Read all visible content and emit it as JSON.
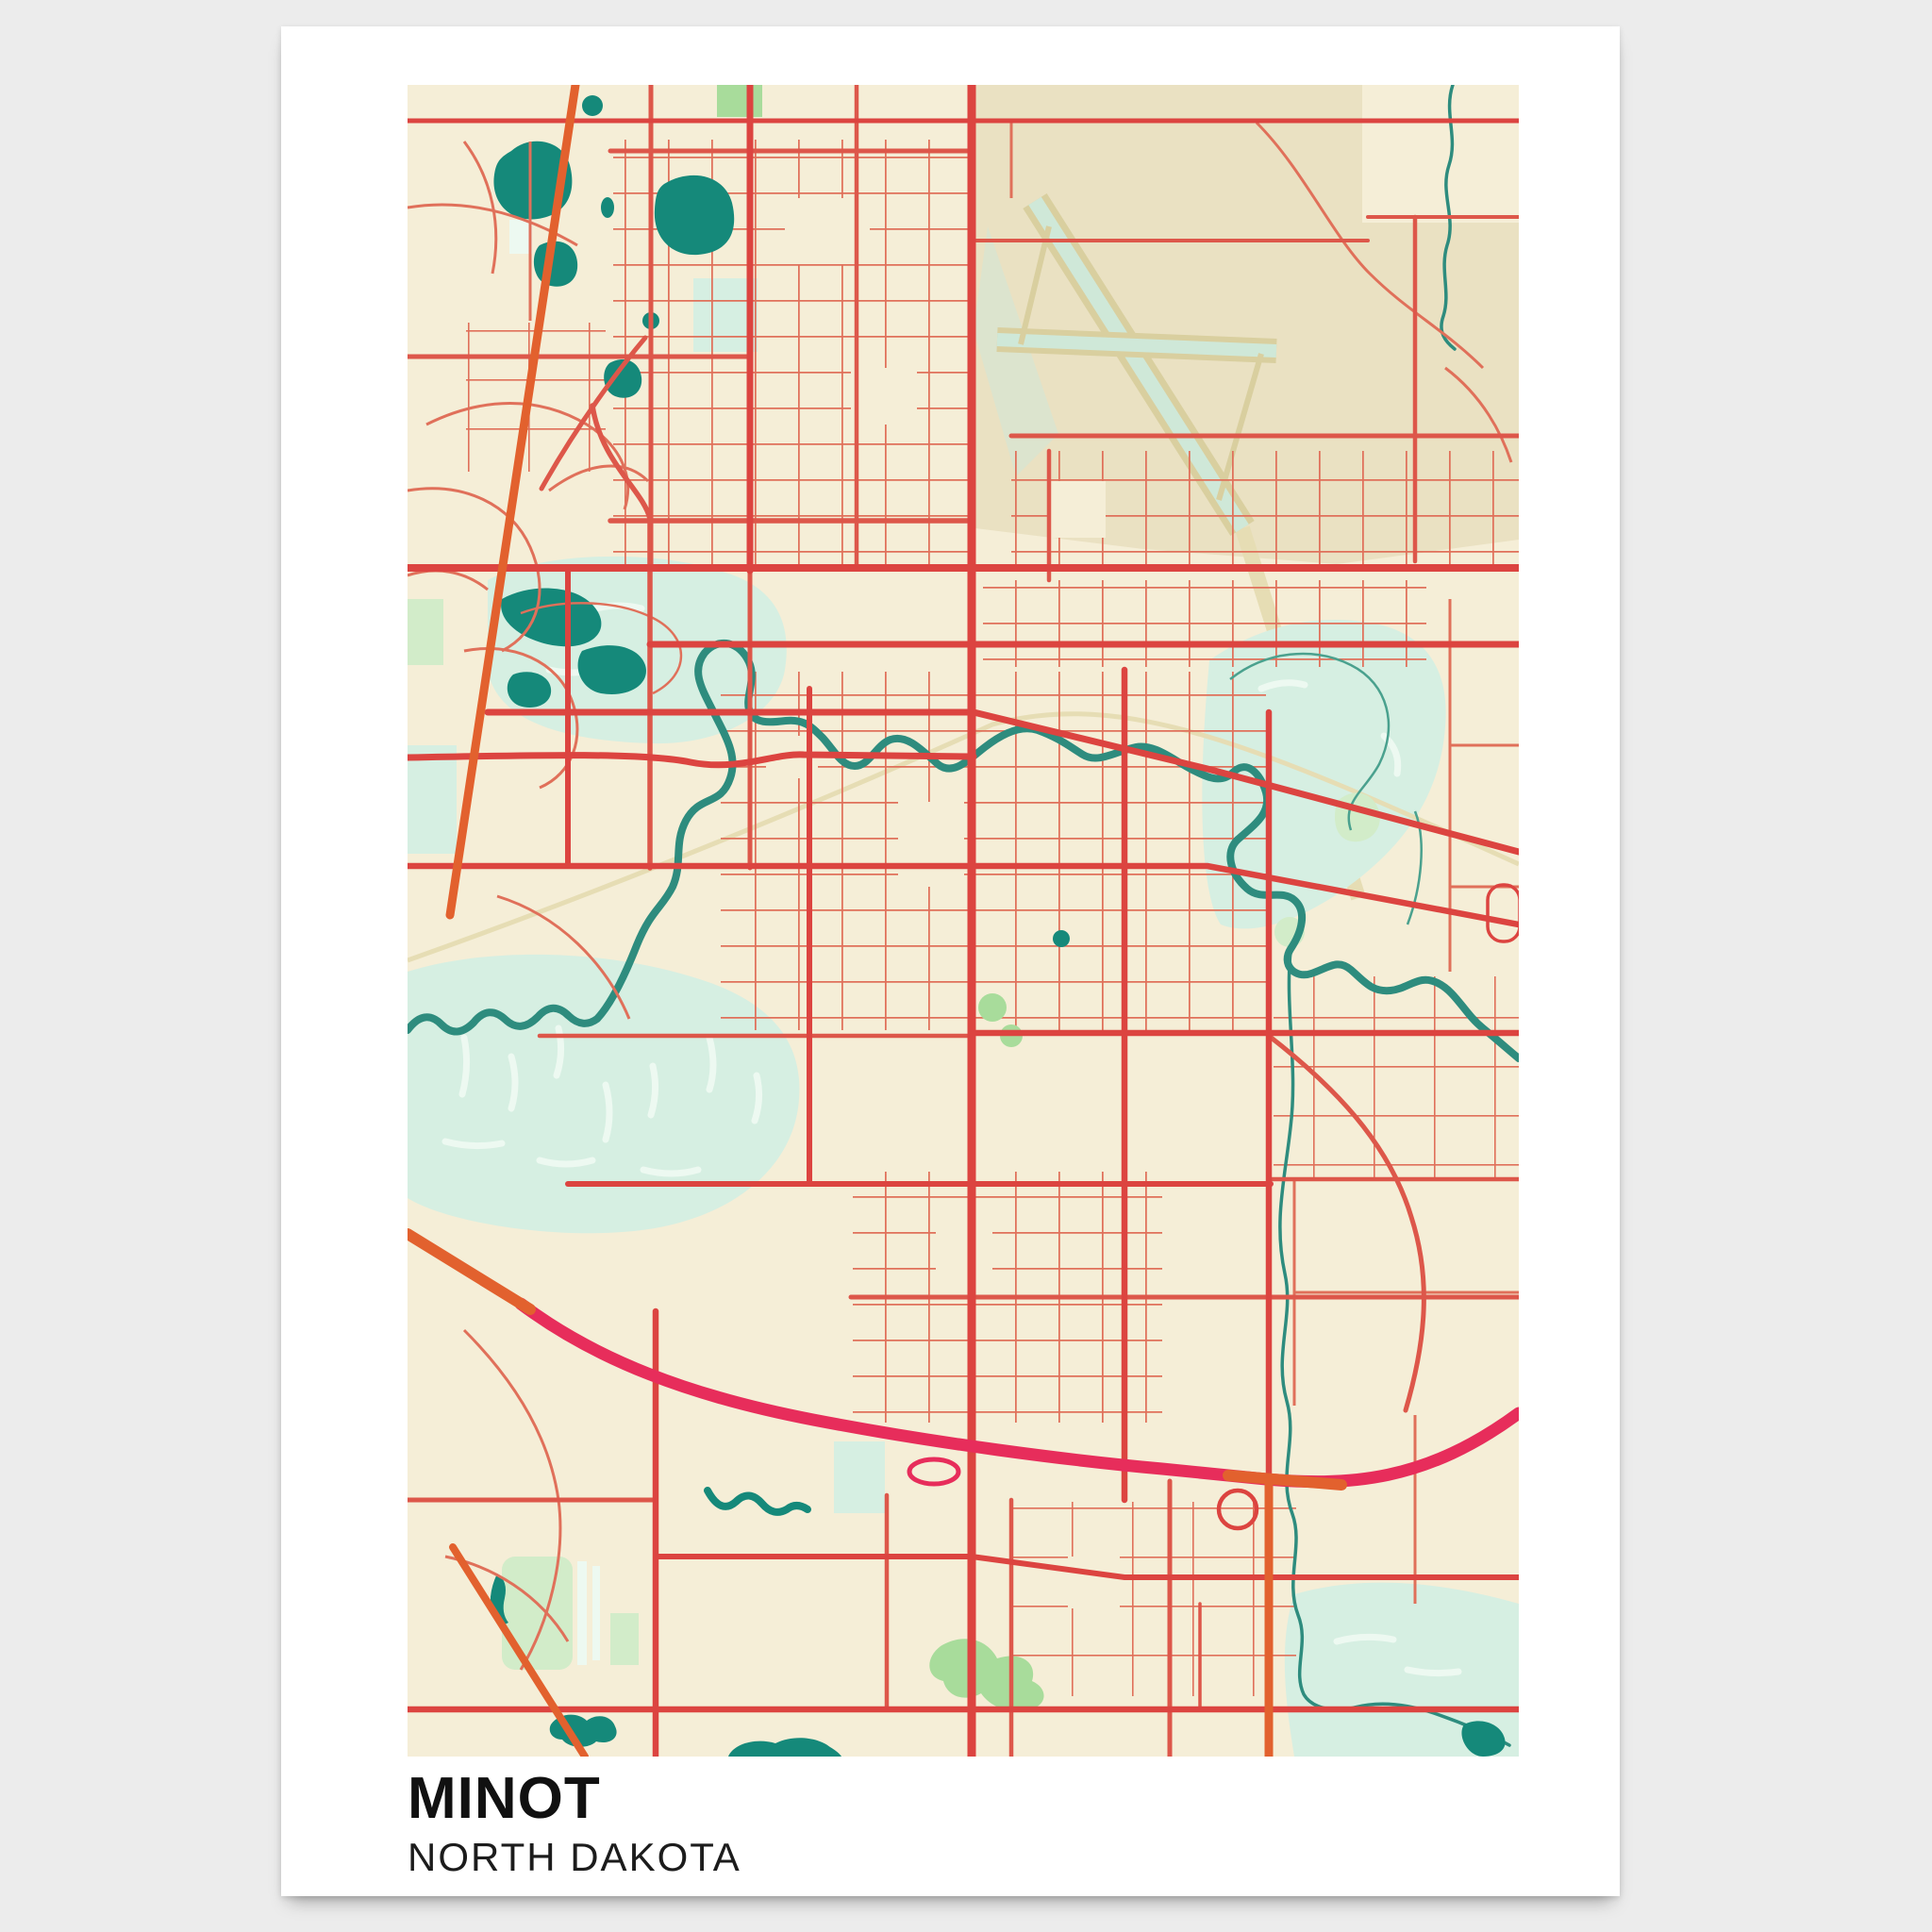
{
  "poster": {
    "title": "MINOT",
    "subtitle": "NORTH DAKOTA"
  },
  "palette": {
    "page_bg": "#ececec",
    "poster_bg": "#ffffff",
    "map_bg": "#f5eed7",
    "district_tan": "#eae1c2",
    "runway_khaki": "#d9cf9f",
    "runway_fill": "#cfe8d8",
    "rail_khaki": "#e6ddb4",
    "road_minor": "#e0705a",
    "road_medium": "#dd574a",
    "road_major": "#dc4440",
    "road_highway": "#e72d5b",
    "road_orange": "#e2612e",
    "water_river": "#2e8c7e",
    "water_lake": "#15897a",
    "water_light": "#d6efe2",
    "water_streak": "#edf9f1",
    "park_green": "#a8dc9b",
    "park_pale": "#d2ecc9",
    "creek_thin": "#4aa18e",
    "title_color": "#111111",
    "subtitle_color": "#1c1c1c"
  },
  "map_features": [
    "city-street-grid",
    "souris-river",
    "oxbow-lakes",
    "west-wetland",
    "airport-runways",
    "bypass-highway",
    "parks",
    "creeks"
  ]
}
